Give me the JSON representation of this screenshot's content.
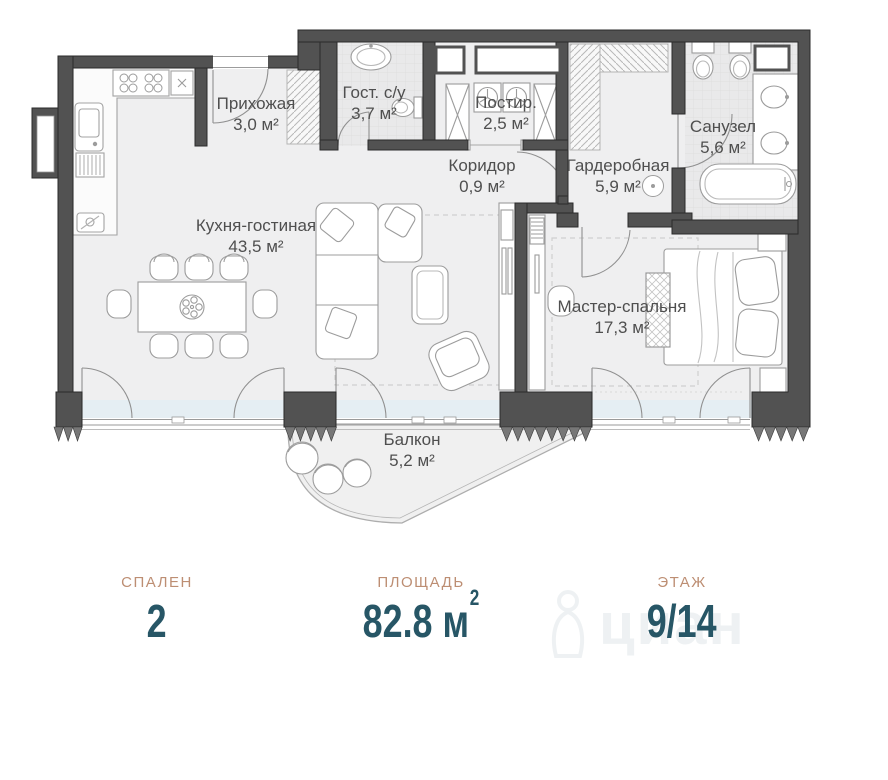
{
  "plan": {
    "rooms": [
      {
        "id": "prihozhaya",
        "name": "Прихожая",
        "area": "3,0 м²"
      },
      {
        "id": "gost-su",
        "name": "Гост. с/у",
        "area": "3,7 м²"
      },
      {
        "id": "postir",
        "name": "Постир.",
        "area": "2,5 м²"
      },
      {
        "id": "koridor",
        "name": "Коридор",
        "area": "0,9 м²"
      },
      {
        "id": "garderobnaya",
        "name": "Гардеробная",
        "area": "5,9 м²"
      },
      {
        "id": "sanuzel",
        "name": "Санузел",
        "area": "5,6 м²"
      },
      {
        "id": "kuhnya-gostinaya",
        "name": "Кухня-гостиная",
        "area": "43,5 м²"
      },
      {
        "id": "master-spalnya",
        "name": "Мастер-спальня",
        "area": "17,3 м²"
      },
      {
        "id": "balkon",
        "name": "Балкон",
        "area": "5,2 м²"
      }
    ]
  },
  "stats": {
    "items": [
      {
        "label": "СПАЛЕН",
        "value": "2",
        "sup": ""
      },
      {
        "label": "ПЛОЩАДЬ",
        "value": "82.8 м",
        "sup": "2"
      },
      {
        "label": "ЭТАЖ",
        "value": "9/14",
        "sup": ""
      }
    ]
  },
  "watermark": {
    "text": "циан"
  },
  "colors": {
    "wall": "#525252",
    "floor": "#efeff0",
    "tile": "#e9e9ea",
    "glass": "#dcedf5",
    "stat_label": "#bd8e73",
    "stat_value": "#275666",
    "label_text": "#4f4f4f"
  }
}
